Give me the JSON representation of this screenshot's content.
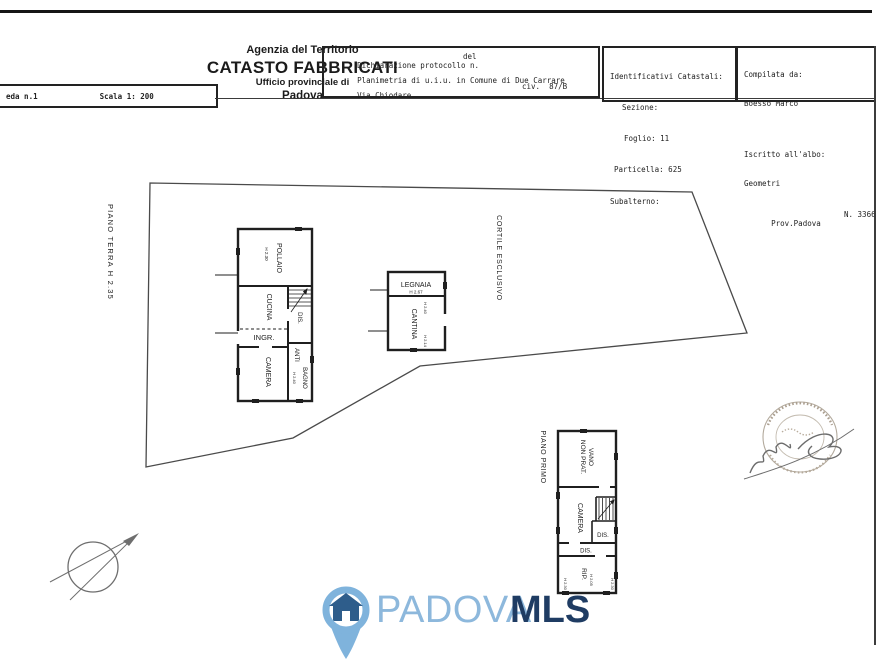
{
  "header": {
    "scale_box": {
      "sheet": "eda n.1",
      "scale": "Scala 1: 200"
    },
    "agency": {
      "line1": "Agenzia del Territorio",
      "line2": "CATASTO FABBRICATI",
      "line3": "Ufficio provinciale di",
      "line4": "Padova"
    },
    "declaration": {
      "protocol": "Dichiarazione protocollo n.",
      "del": "del",
      "planimetria": "Planimetria di u.i.u. in Comune di Due Carrare",
      "street": "Via Chiodare",
      "civ": "civ.  87/B"
    },
    "catasto": {
      "title": "Identificativi Catastali:",
      "sezione": "Sezione:",
      "foglio": "Foglio: 11",
      "particella": "Particella: 625",
      "subalterno": "Subalterno:"
    },
    "compiler": {
      "compilata": "Compilata da:",
      "name": "Boesso Marco",
      "iscritto": "Iscritto all'albo:",
      "albo": "Geometri",
      "prov": "Prov.Padova",
      "num": "N. 3366"
    }
  },
  "plan": {
    "piano_terra": "PIANO TERRA H 2.35",
    "cortile": "CORTILE ESCLUSIVO",
    "piano_primo": "PIANO PRIMO",
    "ground": {
      "pollaio": "POLLAIO",
      "pollaio_h": "H 2.30",
      "cucina": "CUCINA",
      "ingr": "INGR.",
      "dis": "DIS.",
      "anti": "ANTI",
      "bagno": "BAGNO",
      "bagno_h": "H 2.40",
      "camera": "CAMERA"
    },
    "annex": {
      "legnaia": "LEGNAIA",
      "legnaia_h": "H 2.67",
      "cantina": "CANTINA",
      "h_top": "H 2.40",
      "h_bottom": "H 2.14"
    },
    "first": {
      "vano": "VANO",
      "non_prat": "NON PRAT.",
      "camera": "CAMERA",
      "dis_upper": "DIS.",
      "dis_lower": "DIS.",
      "rip": "RIP.",
      "h_left": "H 2.30",
      "h_mid": "H 2.05",
      "h_right": "H 2.30"
    }
  },
  "logo": {
    "padova": "PADOVA",
    "mls": "MLS",
    "colors": {
      "light_blue": "#7fb3dc",
      "navy": "#1f3c63",
      "house_blue": "#2e5d8b"
    }
  }
}
